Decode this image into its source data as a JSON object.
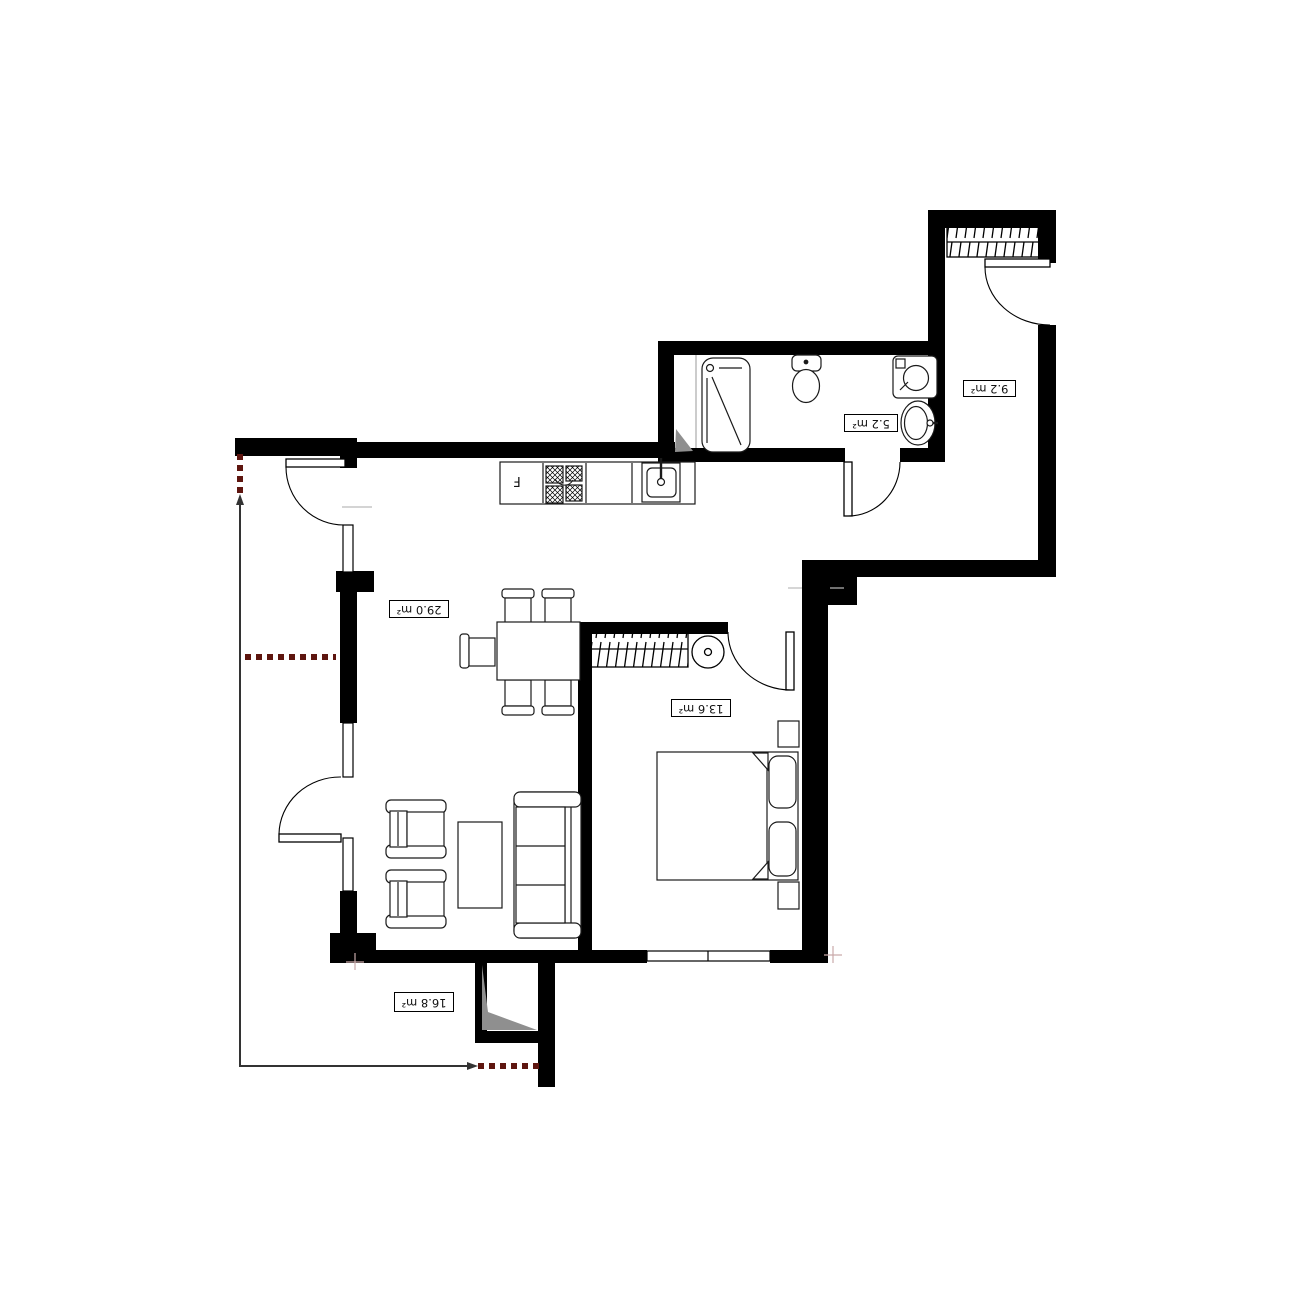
{
  "plan": {
    "title": "apartment-floor-plan",
    "rooms": [
      {
        "id": "living-kitchen",
        "area_label": "29.0 m²"
      },
      {
        "id": "bedroom",
        "area_label": "13.6 m²"
      },
      {
        "id": "terrace",
        "area_label": "16.8 m²"
      },
      {
        "id": "hall",
        "area_label": "9.2 m²"
      },
      {
        "id": "bathroom",
        "area_label": "5.2 m²"
      }
    ],
    "appliance_labels": {
      "fridge": "F"
    },
    "colors": {
      "walls": "#000000",
      "boundary_line": "#333333",
      "boundary_dash": "#5e150f",
      "shade": "#8f8f8f",
      "background": "#ffffff"
    }
  }
}
